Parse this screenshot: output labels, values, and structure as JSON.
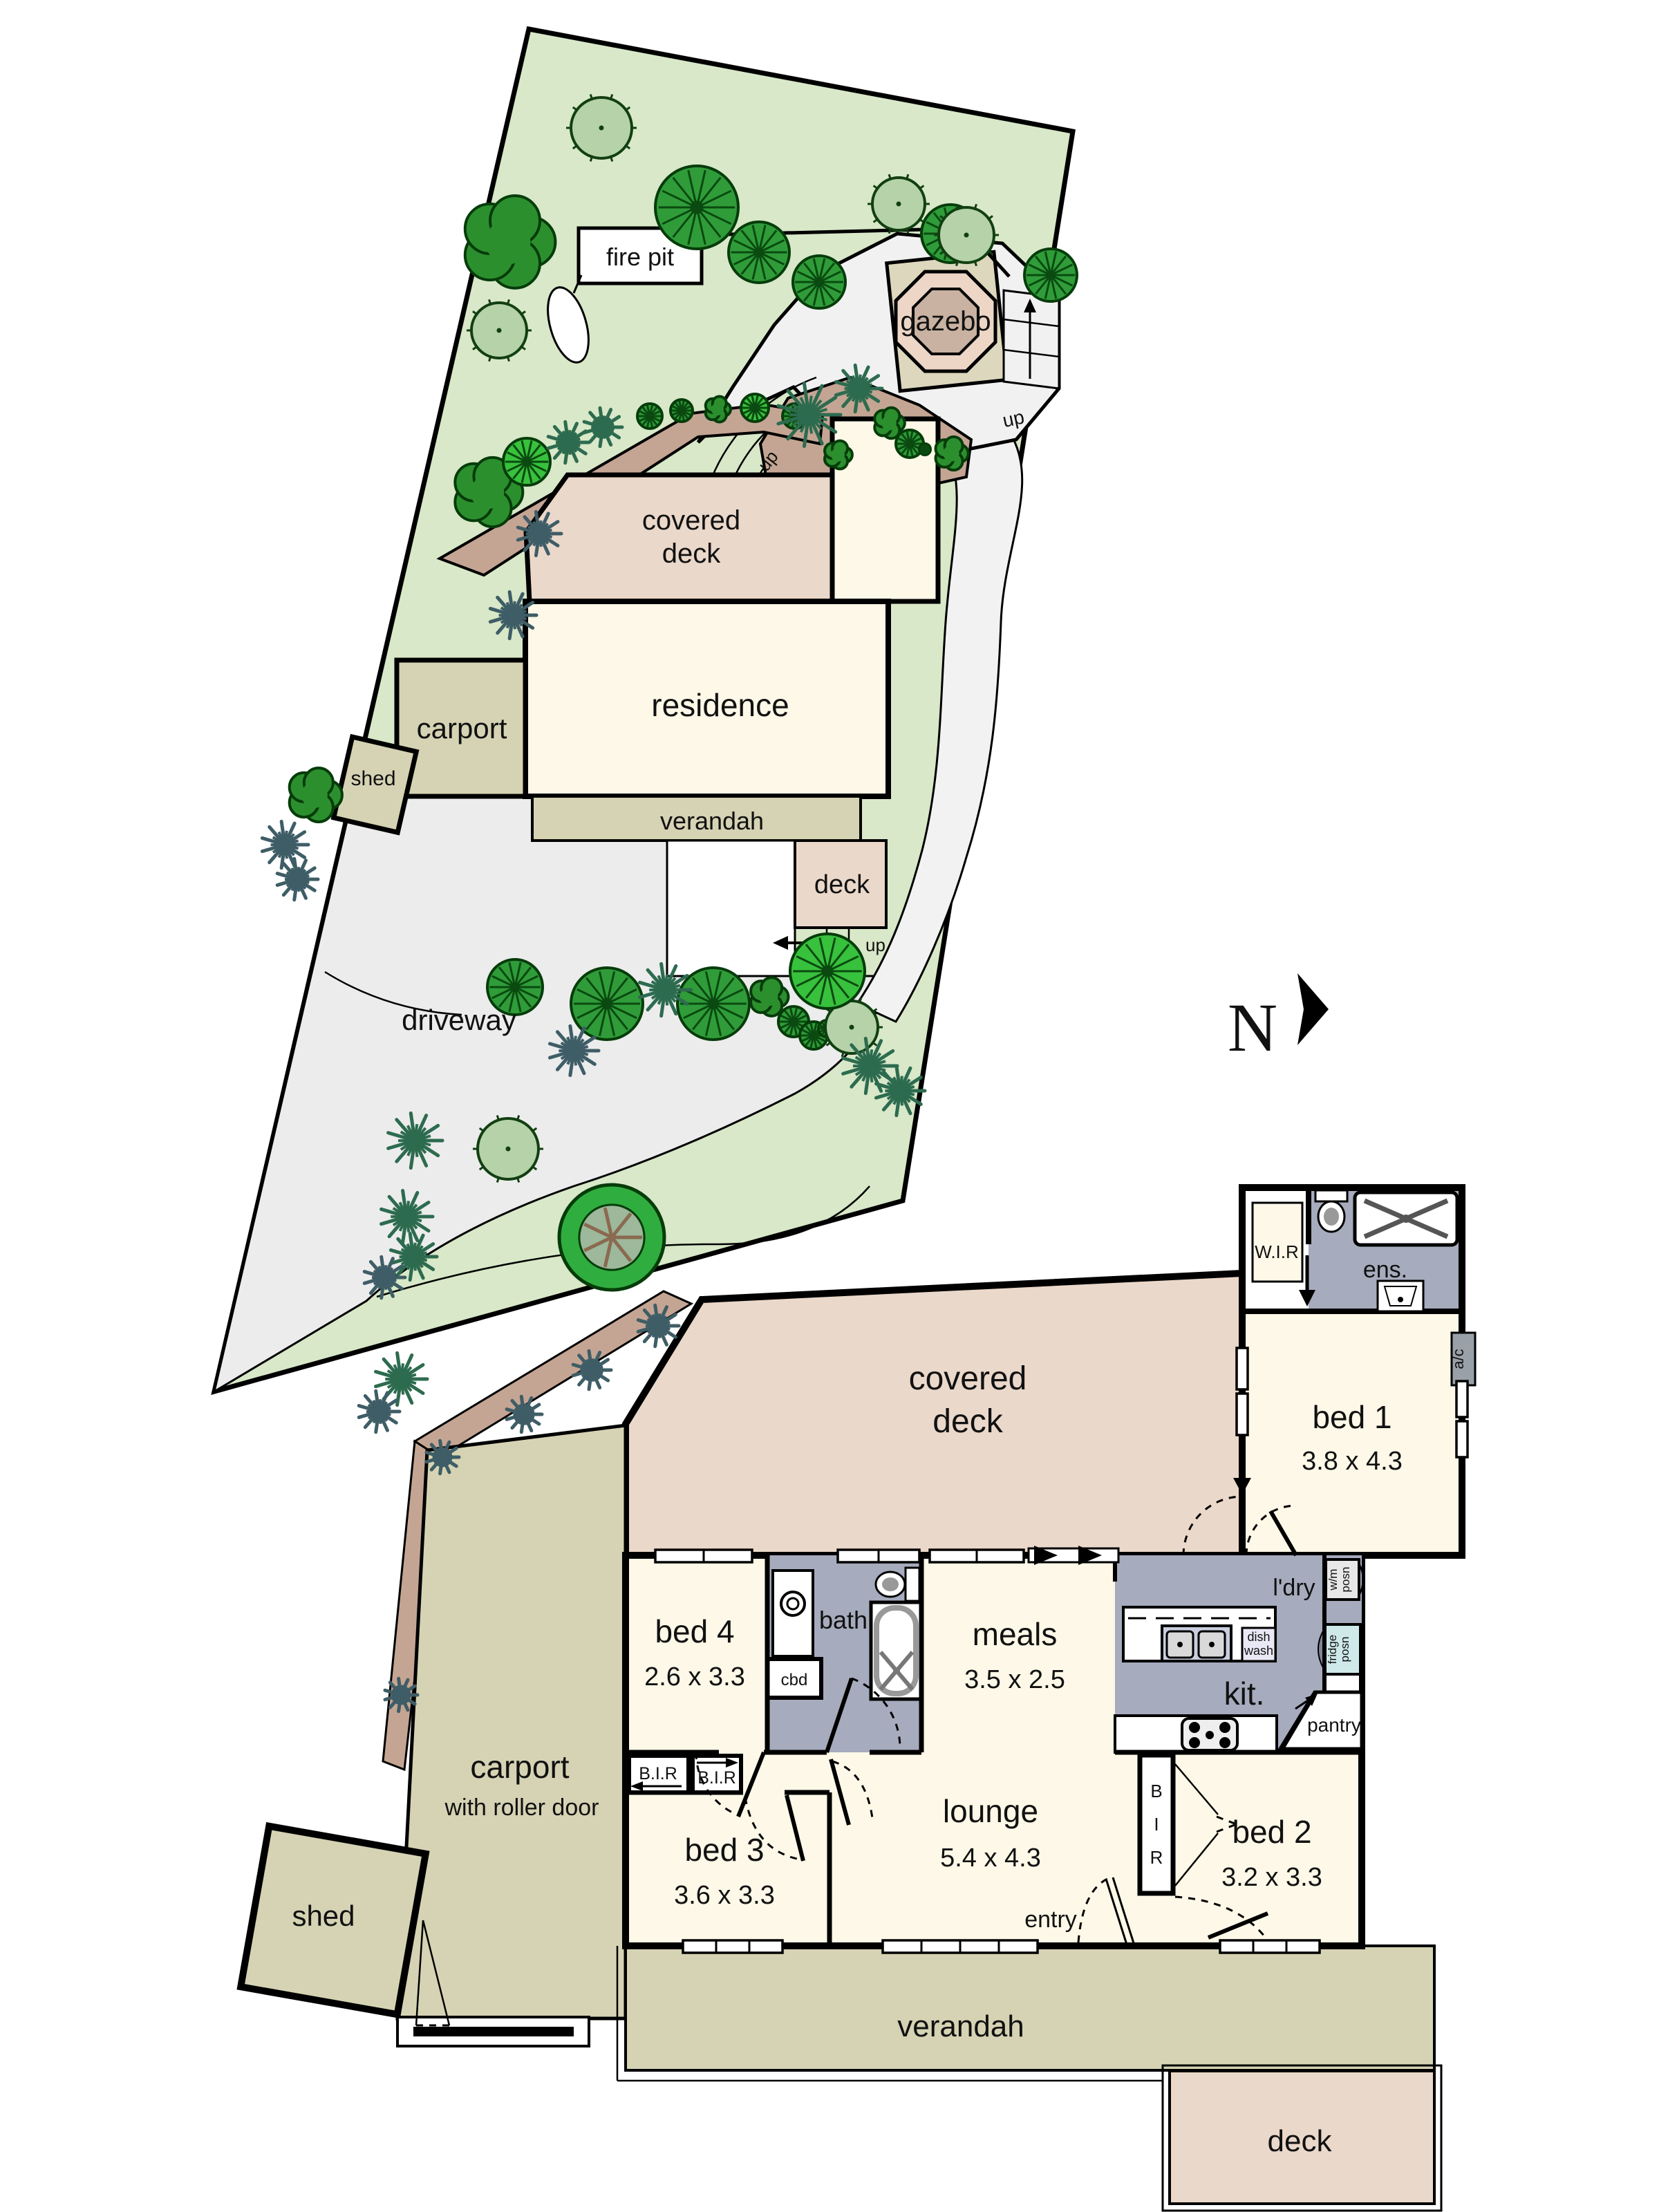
{
  "meta": {
    "type": "floor-plan-diagram"
  },
  "colors": {
    "lawn": "#d8e8c8",
    "driveway": "#ececec",
    "path": "#f2f2f2",
    "deck_pink": "#ead8ca",
    "cream": "#fdf8e7",
    "khaki": "#d5d3b3",
    "wet_gray": "#a6abbd",
    "fridge_blue": "#cfe9ea",
    "garden_brown": "#c4a593",
    "gazebo_outer": "#dcd7bd",
    "gazebo_mid": "#edd6c6",
    "gazebo_inner": "#c9b2a2",
    "tree_light": "#b5d2a8",
    "tree_dark": "#2f9c39",
    "palm_green": "#2d6b4f"
  },
  "north": {
    "label": "N"
  },
  "site_plan": {
    "fire_pit_label": "fire pit",
    "gazebo_label": "gazebo",
    "up_gazebo": "up",
    "up_steps": "up",
    "up_deck": "up",
    "covered_deck_line1": "covered",
    "covered_deck_line2": "deck",
    "residence_label": "residence",
    "carport_label": "carport",
    "shed_label": "shed",
    "verandah_label": "verandah",
    "deck_label": "deck",
    "driveway_label": "driveway"
  },
  "floor_plan": {
    "covered_deck_line1": "covered",
    "covered_deck_line2": "deck",
    "wir_label": "W.I.R",
    "ens_label": "ens.",
    "bed1_name": "bed 1",
    "bed1_dims": "3.8 x 4.3",
    "ac_label": "a/c",
    "ldry_label": "l'dry",
    "wm_line1": "w/m",
    "wm_line2": "posn",
    "fridge_line1": "fridge",
    "fridge_line2": "posn",
    "dish_line1": "dish",
    "dish_line2": "wash",
    "kit_label": "kit.",
    "pantry_label": "pantry",
    "bath_label": "bath",
    "cbd_label": "cbd",
    "bed4_name": "bed 4",
    "bed4_dims": "2.6 x 3.3",
    "meals_name": "meals",
    "meals_dims": "3.5 x 2.5",
    "bir1_label": "B.I.R",
    "bir2_label": "B.I.R",
    "bir_v1": "B",
    "bir_v2": "I",
    "bir_v3": "R",
    "bed3_name": "bed 3",
    "bed3_dims": "3.6 x 3.3",
    "lounge_name": "lounge",
    "lounge_dims": "5.4 x 4.3",
    "entry_label": "entry",
    "bed2_name": "bed 2",
    "bed2_dims": "3.2 x 3.3",
    "carport_name": "carport",
    "carport_sub": "with roller door",
    "shed_label": "shed",
    "verandah_label": "verandah",
    "deck_label": "deck"
  }
}
